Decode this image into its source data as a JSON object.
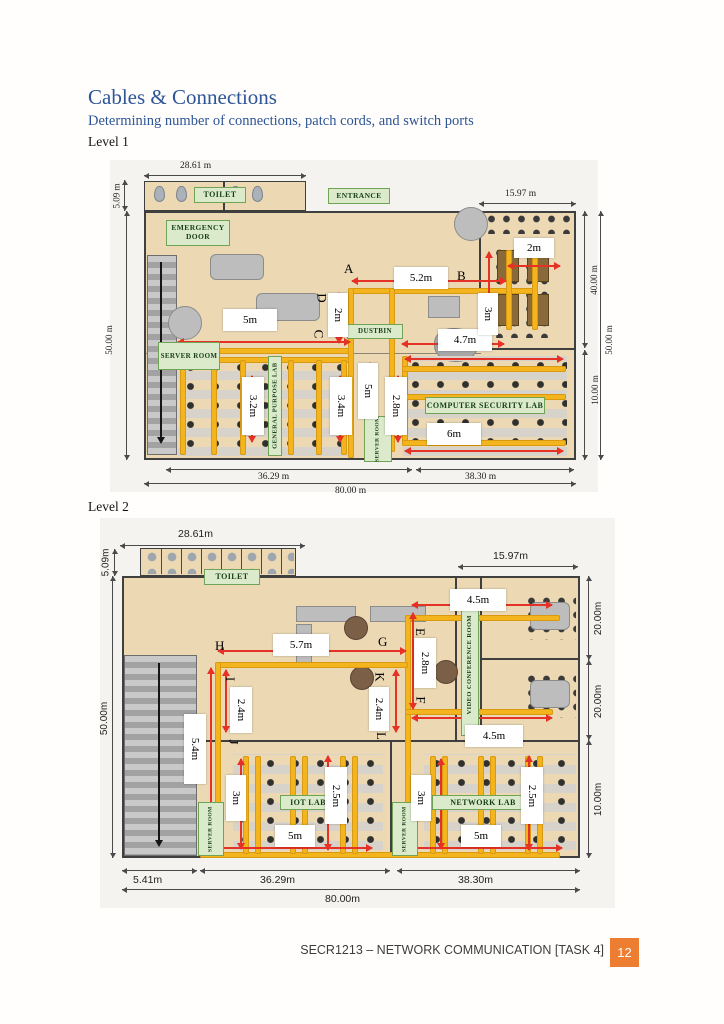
{
  "doc": {
    "title": "Cables & Connections",
    "subtitle": "Determining number of connections, patch cords, and switch ports",
    "level1_label": "Level 1",
    "level2_label": "Level 2",
    "footer_text": "SECR1213 – NETWORK COMMUNICATION [TASK 4]",
    "page_number": "12"
  },
  "colors": {
    "heading_blue": "#2e5596",
    "cable_gold": "#f4b41e",
    "arrow_red": "#e63226",
    "room_label_green": "#daeacb",
    "floor_tan": "#ecd9b4",
    "page_badge_orange": "#ed7d31"
  },
  "l1": {
    "rooms": {
      "toilet": "TOILET",
      "entrance": "ENTRANCE",
      "emergency_door": "EMERGENCY DOOR",
      "server_room": "SERVER ROOM",
      "dustbin": "DUSTBIN",
      "general_purpose_lab": "GENERAL PURPOSE LAB",
      "computer_security_lab": "COMPUTER SECURITY LAB",
      "server_room_small": "SERVER ROOM"
    },
    "dims": {
      "top_width": "28.61 m",
      "toilet_height": "5.09 m",
      "right_width": "15.97 m",
      "right_upper": "40.00 m",
      "right_total": "50.00 m",
      "right_lower": "10.00 m",
      "left_height": "50.00 m",
      "bottom_left": "36.29 m",
      "bottom_right": "38.30 m",
      "bottom_total": "80.00 m"
    },
    "measurements": {
      "ab_run": "5.2m",
      "d_drop": "2m",
      "c_run": "5m",
      "pantry_run": "4.7m",
      "b_drop": "3m",
      "table_width": "2m",
      "gp_col_1": "3.2m",
      "gp_col_2": "3.4m",
      "mid_drop": "5m",
      "cs_drop": "2.8m",
      "cs_run": "6m"
    },
    "points": {
      "a": "A",
      "b": "B",
      "c": "C",
      "d": "D"
    }
  },
  "l2": {
    "rooms": {
      "toilet": "TOILET",
      "video_conference": "VIDEO CONFERENCE ROOM",
      "iot_lab": "IOT LAB",
      "network_lab": "NETWORK LAB",
      "server_room_left": "SERVER ROOM",
      "server_room_right": "SERVER ROOM"
    },
    "dims": {
      "top_width": "28.61m",
      "toilet_height": "5.09m",
      "right_width": "15.97m",
      "right_room1": "20.00m",
      "right_room2": "20.00m",
      "right_lab": "10.00m",
      "left_height": "50.00m",
      "bottom_stairs": "5.41m",
      "bottom_left": "36.29m",
      "bottom_right": "38.30m",
      "bottom_total": "80.00m"
    },
    "measurements": {
      "e_run": "4.5m",
      "hg_run": "5.7m",
      "e_drop": "2.8m",
      "ij_drop": "2.4m",
      "kl_drop": "2.4m",
      "l_run": "4.5m",
      "left_drop": "5.4m",
      "iot_3m": "3m",
      "iot_25m": "2.5m",
      "iot_5m": "5m",
      "net_3m": "3m",
      "net_25m": "2.5m",
      "net_5m": "5m"
    },
    "points": {
      "h": "H",
      "g": "G",
      "e": "E",
      "f": "F",
      "i": "I",
      "j": "J",
      "k": "K",
      "l": "L"
    }
  }
}
